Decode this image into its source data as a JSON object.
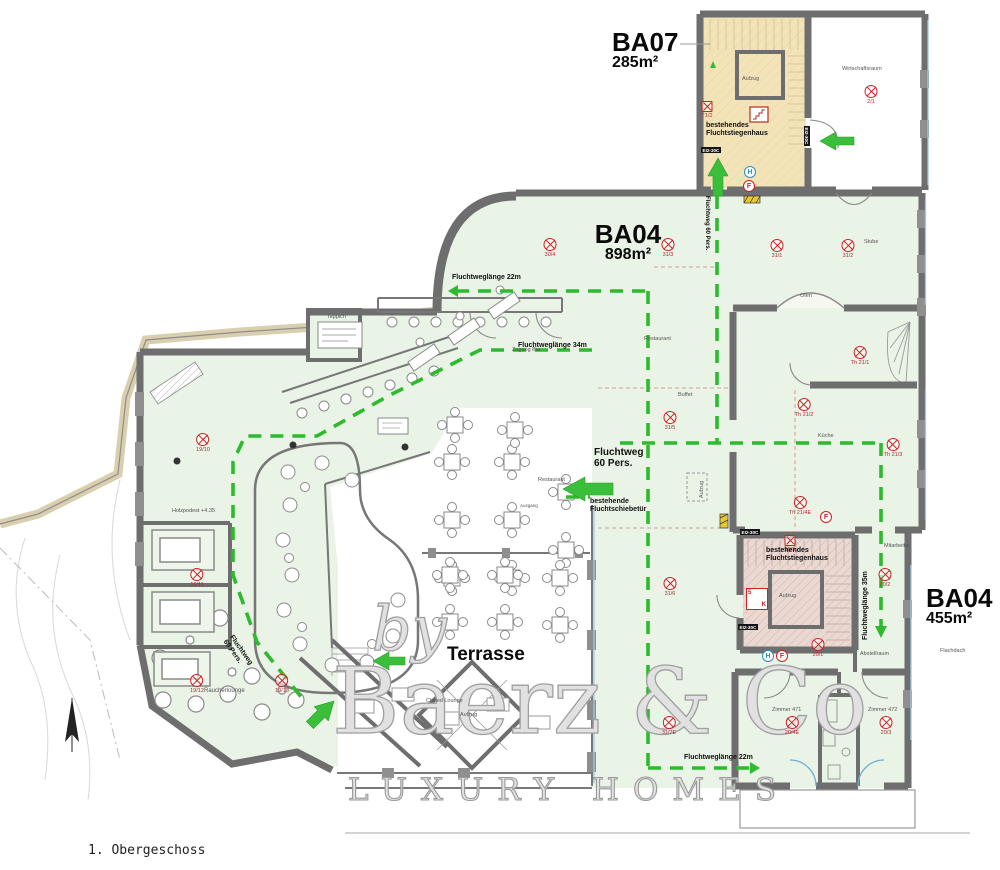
{
  "drawing_title": "1. Obergeschoss",
  "watermark": {
    "by": "by",
    "brand": "Baerz & Co",
    "tagline": "LUXURY HOMES"
  },
  "areas": {
    "ba07": {
      "name": "BA07",
      "size": "285m²"
    },
    "ba04_main": {
      "name": "BA04",
      "size": "898m²"
    },
    "ba04_east": {
      "name": "BA04",
      "size": "455m²"
    }
  },
  "terrace_label": "Terrasse",
  "room_labels": [
    {
      "text": "Wirtschaftsraum",
      "x": 842,
      "y": 66
    },
    {
      "text": "Stube",
      "x": 864,
      "y": 239
    },
    {
      "text": "Ofen",
      "x": 800,
      "y": 293
    },
    {
      "text": "Buffet",
      "x": 678,
      "y": 392
    },
    {
      "text": "Restaurant",
      "x": 644,
      "y": 336
    },
    {
      "text": "Restaurant",
      "x": 538,
      "y": 477
    },
    {
      "text": "Küche",
      "x": 818,
      "y": 433
    },
    {
      "text": "Zugang Bar",
      "x": 512,
      "y": 347
    },
    {
      "text": "Teppich",
      "x": 327,
      "y": 314
    },
    {
      "text": "Mitarbeiter",
      "x": 884,
      "y": 543
    },
    {
      "text": "Flachdach",
      "x": 940,
      "y": 648
    },
    {
      "text": "Abstellraum",
      "x": 860,
      "y": 651
    },
    {
      "text": "Zimmer 471",
      "x": 772,
      "y": 707
    },
    {
      "text": "Zimmer 472",
      "x": 868,
      "y": 707
    },
    {
      "text": "Raucherlounge",
      "x": 204,
      "y": 688,
      "s": 6
    },
    {
      "text": "Holzpodest +4.35",
      "x": 172,
      "y": 508
    },
    {
      "text": "Chilled Lounge",
      "x": 426,
      "y": 698
    },
    {
      "text": "Ausgang",
      "x": 520,
      "y": 504,
      "s": 4.5
    },
    {
      "text": "Aufzug",
      "x": 742,
      "y": 76
    },
    {
      "text": "Aufzug",
      "x": 779,
      "y": 593
    },
    {
      "text": "Aufzug",
      "x": 699,
      "y": 498,
      "rot": -90
    },
    {
      "text": "Aufzug",
      "x": 460,
      "y": 712
    }
  ],
  "escape_labels": [
    {
      "text": "Fluchtweglänge 22m",
      "x": 452,
      "y": 274
    },
    {
      "text": "Fluchtweglänge 34m",
      "x": 518,
      "y": 342
    },
    {
      "text": "Fluchtweglänge 22m",
      "x": 684,
      "y": 754
    },
    {
      "text": "Fluchtweglänge 35m",
      "x": 862,
      "y": 640,
      "rot": -90
    },
    {
      "text": "Fluchtweg  60 Pers.",
      "x": 710,
      "y": 196,
      "rot": 90,
      "s": 6
    },
    {
      "text": "Fluchtweg\n60 Pers.",
      "x": 594,
      "y": 448,
      "s": 10
    },
    {
      "text": "Fluchtweg\n60 Pers.",
      "x": 234,
      "y": 634,
      "rot": 55,
      "s": 7
    },
    {
      "text": "bestehendes\nFluchtstiegenhaus",
      "x": 706,
      "y": 122
    },
    {
      "text": "bestehendes\nFluchtstiegenhaus",
      "x": 766,
      "y": 547
    },
    {
      "text": "bestehende\nFluchtschiebetür",
      "x": 590,
      "y": 498
    }
  ],
  "symbols": [
    {
      "code": "2/1",
      "x": 871,
      "y": 92
    },
    {
      "code": "T1/2",
      "x": 707,
      "y": 108,
      "shape": "square"
    },
    {
      "code": "30/4",
      "x": 550,
      "y": 245
    },
    {
      "code": "31/3",
      "x": 668,
      "y": 245
    },
    {
      "code": "31/1",
      "x": 777,
      "y": 246
    },
    {
      "code": "31/2",
      "x": 848,
      "y": 246
    },
    {
      "code": "Th 21/1",
      "x": 860,
      "y": 353
    },
    {
      "code": "Th 21/2",
      "x": 804,
      "y": 405
    },
    {
      "code": "Th 21/3",
      "x": 893,
      "y": 445
    },
    {
      "code": "31/5",
      "x": 670,
      "y": 418
    },
    {
      "code": "Th 21/4E",
      "x": 800,
      "y": 503
    },
    {
      "code": "15/3",
      "x": 790,
      "y": 542,
      "shape": "square"
    },
    {
      "code": "20/2",
      "x": 885,
      "y": 575
    },
    {
      "code": "31/6",
      "x": 670,
      "y": 584
    },
    {
      "code": "20/1",
      "x": 818,
      "y": 645
    },
    {
      "code": "31/7E",
      "x": 669,
      "y": 723
    },
    {
      "code": "20/4E",
      "x": 792,
      "y": 723
    },
    {
      "code": "20/3",
      "x": 886,
      "y": 723
    },
    {
      "code": "19/10",
      "x": 203,
      "y": 440
    },
    {
      "code": "19/11",
      "x": 197,
      "y": 575
    },
    {
      "code": "19/12",
      "x": 197,
      "y": 681
    },
    {
      "code": "19/13",
      "x": 282,
      "y": 681
    }
  ],
  "badges": [
    {
      "letter": "H",
      "x": 744,
      "y": 166,
      "color": "blue"
    },
    {
      "letter": "F",
      "x": 743,
      "y": 180,
      "color": "red"
    },
    {
      "letter": "H",
      "x": 762,
      "y": 650,
      "color": "blue"
    },
    {
      "letter": "F",
      "x": 776,
      "y": 650,
      "color": "red"
    },
    {
      "letter": "F",
      "x": 820,
      "y": 511,
      "color": "red"
    }
  ],
  "fire_boxes": [
    {
      "text": "EI2-30C",
      "x": 701,
      "y": 147
    },
    {
      "text": "EI2-30C",
      "x": 810,
      "y": 126,
      "rot": 90
    },
    {
      "text": "EI2-30C",
      "x": 740,
      "y": 529
    },
    {
      "text": "EI2-30C",
      "x": 738,
      "y": 624
    }
  ],
  "stair_sign": {
    "top": "5",
    "bottom": "K"
  },
  "colors": {
    "escape_green": "#2eba2e",
    "interior_green": "#e9f3e6",
    "stair_tan": "#f3e3b8",
    "stair_rose": "#ead9d3",
    "wall_gray": "#6e6e6e",
    "symbol_red": "#cc2222",
    "window_blue": "#9fc8e0",
    "terrain_tan": "#d9cfae"
  }
}
